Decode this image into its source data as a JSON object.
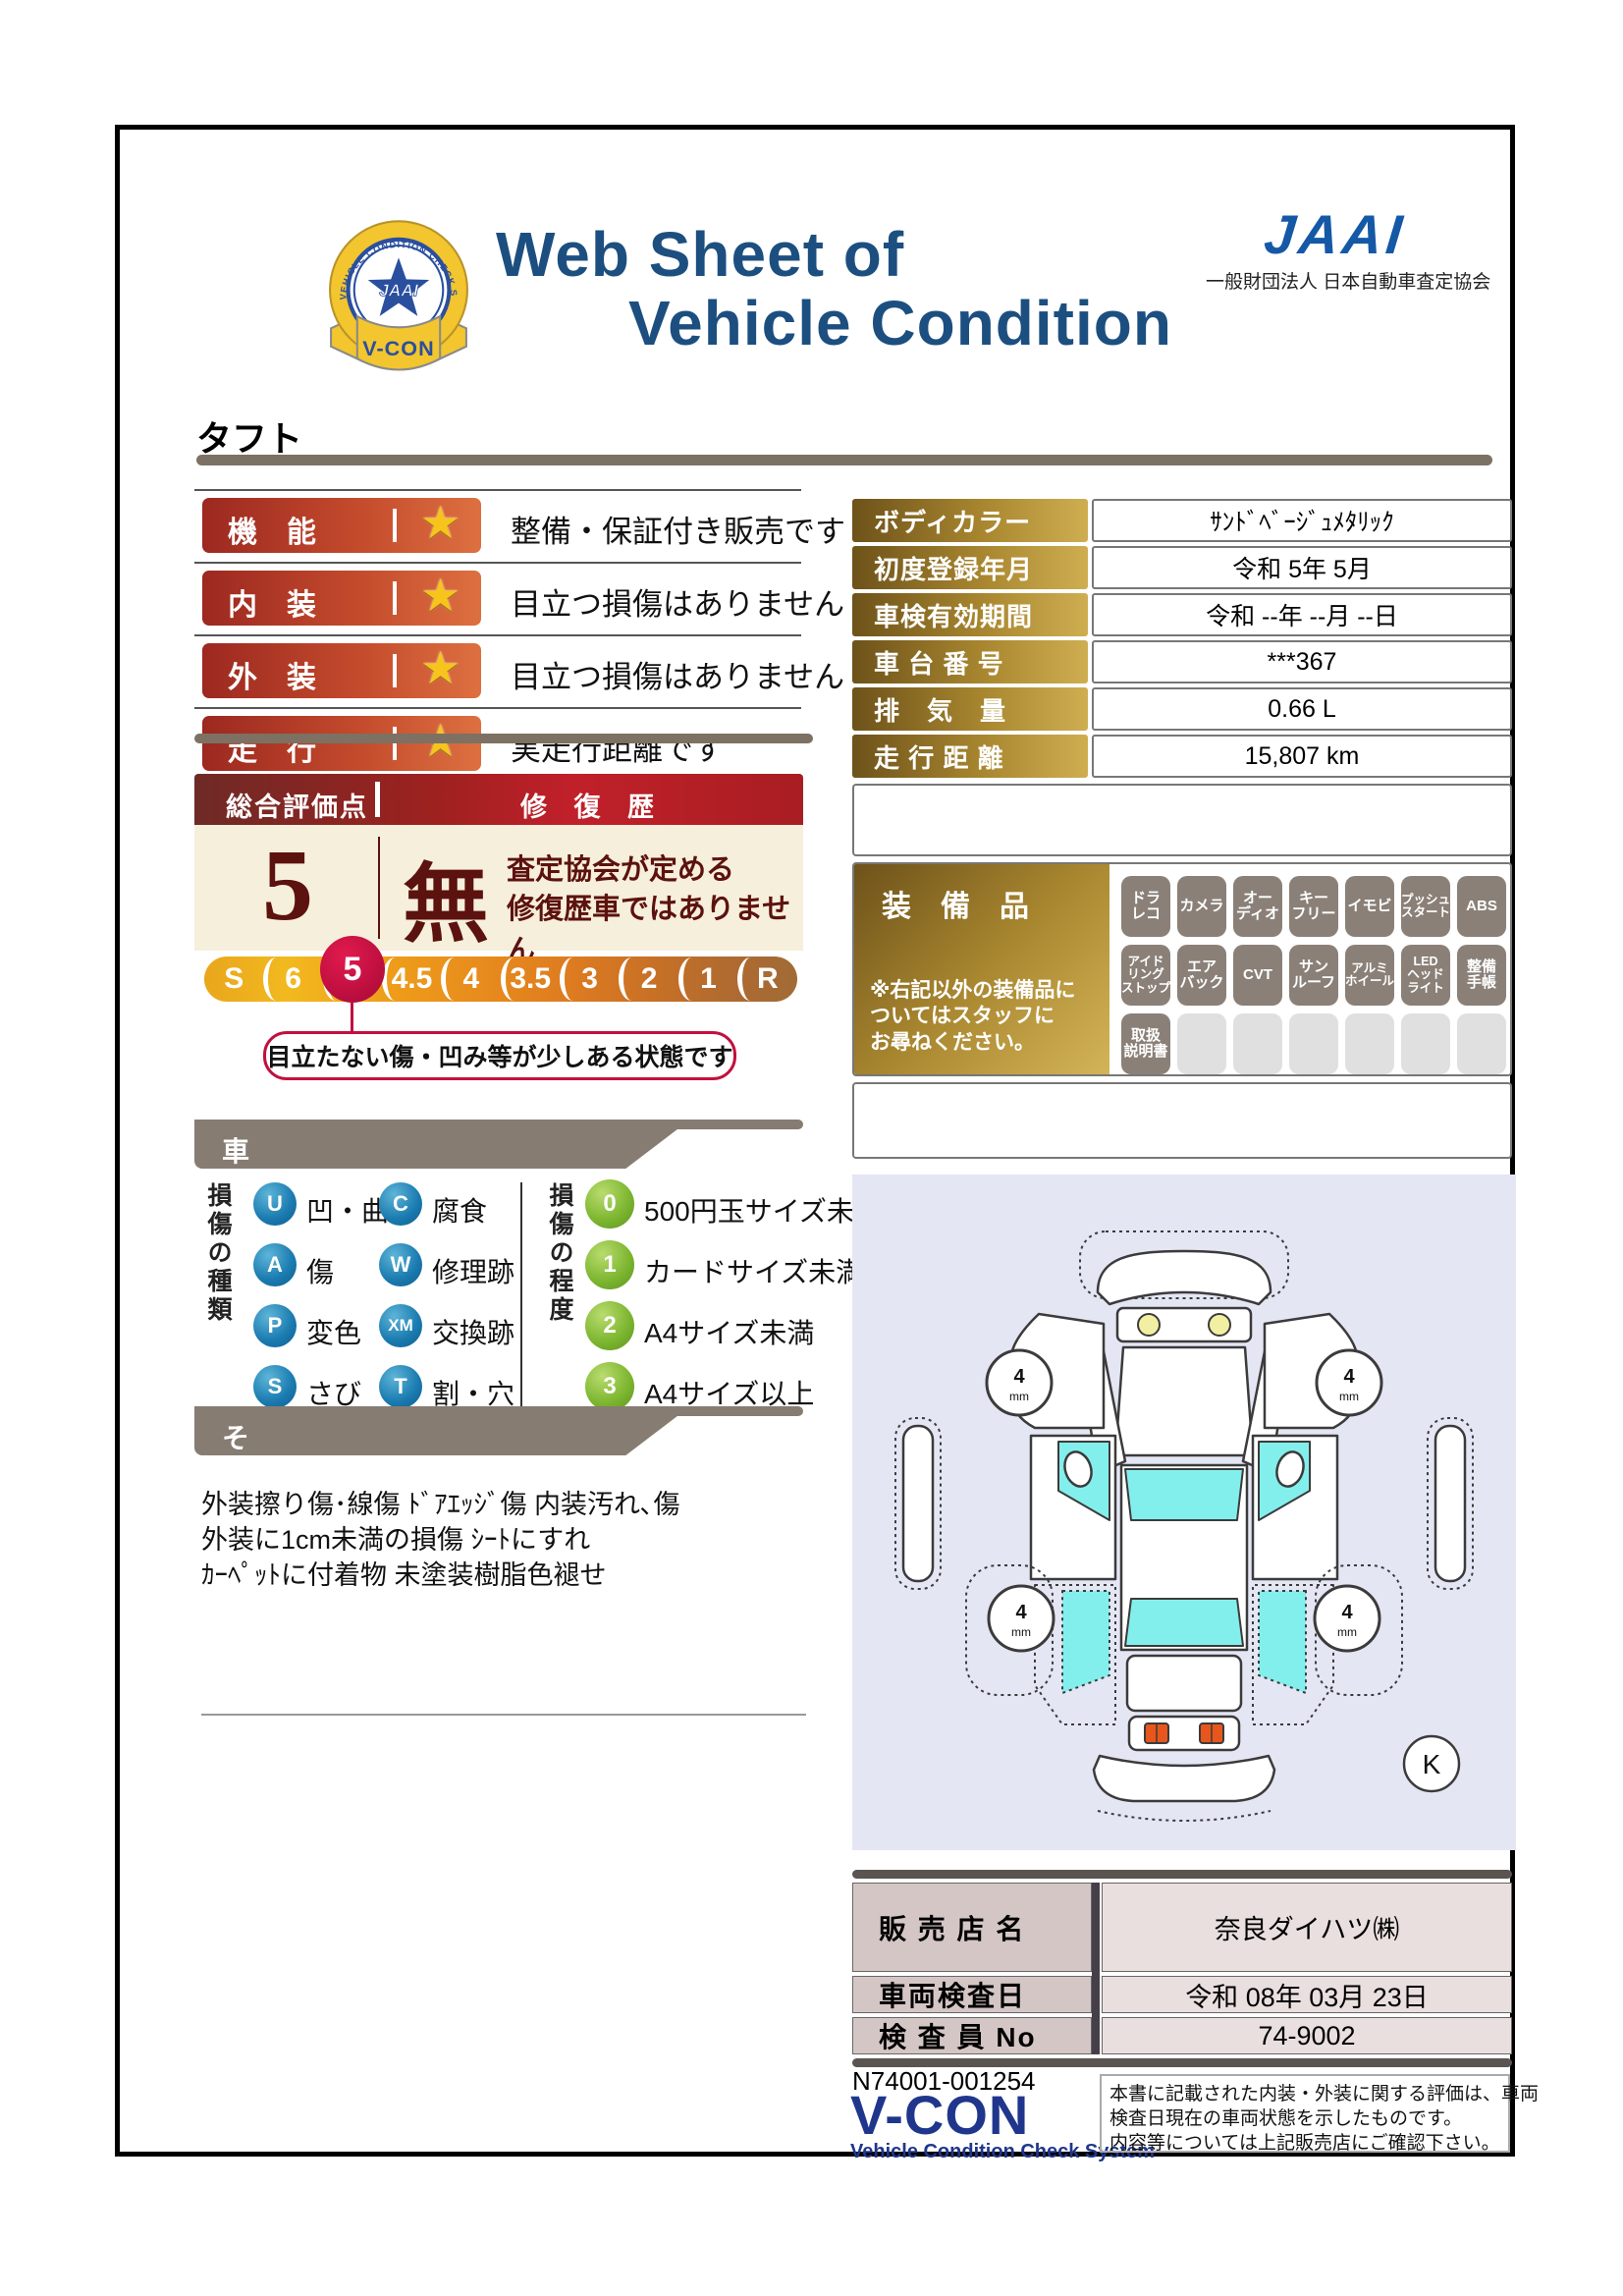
{
  "header": {
    "title_line1": "Web Sheet of",
    "title_line2": "Vehicle Condition",
    "jaai_logo": "JAAI",
    "jaai_subtitle": "一般財団法人 日本自動車査定協会",
    "badge": {
      "ring_text": "VEHICLE CONDITION CHECK SYSTEM",
      "center": "JAAI",
      "ribbon": "V-CON"
    }
  },
  "vehicle_name": "タフト",
  "ratings": [
    {
      "label": "機　能",
      "desc": "整備・保証付き販売です"
    },
    {
      "label": "内　装",
      "desc": "目立つ損傷はありません"
    },
    {
      "label": "外　装",
      "desc": "目立つ損傷はありません"
    },
    {
      "label": "走　行",
      "desc": "実走行距離です"
    }
  ],
  "icons": {
    "star": "★"
  },
  "overall": {
    "header_left": "総合評価点",
    "header_right": "修 復 歴",
    "score": "5",
    "repair_mark": "無",
    "repair_text_line1": "査定協会が定める",
    "repair_text_line2": "修復歴車ではありません",
    "scale": [
      "S",
      "6",
      "5",
      "4.5",
      "4",
      "3.5",
      "3",
      "2",
      "1",
      "R"
    ],
    "selected": "5",
    "callout": "目立たない傷・凹み等が少しある状態です"
  },
  "info": {
    "rows": [
      {
        "label": "ボディカラー",
        "value": "ｻﾝﾄﾞﾍﾞｰｼﾞｭﾒﾀﾘｯｸ"
      },
      {
        "label": "初度登録年月",
        "value": "令和 5年 5月"
      },
      {
        "label": "車検有効期間",
        "value": "令和 --年 --月 --日"
      },
      {
        "label": "車 台 番 号",
        "value": "***367"
      },
      {
        "label": "排　気　量",
        "value": "0.66 L"
      },
      {
        "label": "走 行 距 離",
        "value": "15,807 km"
      }
    ]
  },
  "equipment": {
    "title": "装　備　品",
    "note": "※右記以外の装備品に\nついてはスタッフに\nお尋ねください。",
    "rows": [
      [
        "ドラ\nレコ",
        "カメラ",
        "オー\nディオ",
        "キー\nフリー",
        "イモビ",
        "プッシュ\nスタート",
        "ABS"
      ],
      [
        "アイド\nリング\nストップ",
        "エア\nバック",
        "CVT",
        "サン\nルーフ",
        "アルミ\nホイール",
        "LED\nヘッド\nライト",
        "整備\n手帳"
      ],
      [
        "取扱\n説明書",
        "",
        "",
        "",
        "",
        "",
        ""
      ]
    ]
  },
  "exterior": {
    "title": "車両外装の状態",
    "type_label": "損傷の種類",
    "types": [
      {
        "code": "U",
        "label": "凹・曲"
      },
      {
        "code": "C",
        "label": "腐食"
      },
      {
        "code": "A",
        "label": "傷"
      },
      {
        "code": "W",
        "label": "修理跡"
      },
      {
        "code": "P",
        "label": "変色"
      },
      {
        "code": "XM",
        "label": "交換跡"
      },
      {
        "code": "S",
        "label": "さび"
      },
      {
        "code": "T",
        "label": "割・穴"
      }
    ],
    "degree_label": "損傷の程度",
    "degrees": [
      {
        "code": "0",
        "label": "500円玉サイズ未満"
      },
      {
        "code": "1",
        "label": "カードサイズ未満"
      },
      {
        "code": "2",
        "label": "A4サイズ未満"
      },
      {
        "code": "3",
        "label": "A4サイズ以上"
      }
    ]
  },
  "other": {
    "title": "その他の状態",
    "lines": [
      "外装擦り傷･線傷 ﾄﾞｱｴｯｼﾞ傷 内装汚れ､傷",
      "外装に1cm未満の損傷 ｼｰﾄにすれ",
      "ｶｰﾍﾟｯﾄに付着物 未塗装樹脂色褪せ"
    ]
  },
  "diagram": {
    "tire_value": "4",
    "tire_unit": "mm",
    "k_label": "K"
  },
  "dealer": {
    "rows": [
      {
        "label": "販 売 店 名",
        "value": "奈良ダイハツ㈱"
      },
      {
        "label": "車両検査日",
        "value": "令和 08年 03月 23日"
      },
      {
        "label": "検 査 員 No",
        "value": "74-9002"
      }
    ]
  },
  "footer": {
    "serial": "N74001-001254",
    "vcon": "V-CON",
    "vcon_sub": "Vehicle Condition Check System",
    "note_lines": [
      "本書に記載された内装・外装に関する評価は、車両",
      "検査日現在の車両状態を示したものです。",
      "内容等については上記販売店にご確認下さい。"
    ]
  },
  "colors": {
    "title_blue": "#1c4f80",
    "jaai_blue": "#1558a6",
    "maroon": "#5c120e",
    "accent_red": "#c2103f",
    "gold_dark": "#6d521a",
    "gold_light": "#cfae52",
    "banner_gray": "#877c72",
    "window_cyan": "#83efec",
    "vcon_blue": "#20368c"
  }
}
